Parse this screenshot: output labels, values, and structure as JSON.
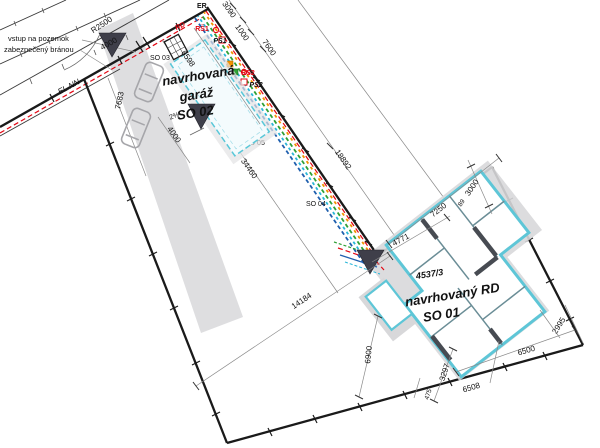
{
  "plan": {
    "notes": {
      "entrance_line1": "vstup na pozemok",
      "entrance_line2": "zabezpečený bránou"
    },
    "road_labels": {
      "el_nn": "EL.NN",
      "r2500": "R2500",
      "width": "4000"
    },
    "utility_labels": {
      "er": "ER",
      "rd": "RD",
      "rs1": "RŠ1",
      "ps1": "PŠ1",
      "rs2": "RŠ2",
      "ps2": "PŠ2",
      "so03": "SO 03",
      "so04": "SO 04",
      "so05": "SO 05"
    },
    "garage": {
      "line1": "navrhovaná",
      "line2": "garáž",
      "line3": "SO 02",
      "slope": "2%"
    },
    "house": {
      "parcel": "4537/3",
      "line1": "navrhovaný RD",
      "line2": "SO 01"
    },
    "dimensions": {
      "d3090": "3090",
      "d1000": "1000",
      "d7600": "7600",
      "d18892": "18892",
      "d34460": "34460",
      "d6598": "6598",
      "d7683": "7683",
      "d4000g": "4000",
      "d14184": "14184",
      "d7250": "7250",
      "d4771": "4771",
      "d3000": "3000",
      "d89": "89",
      "d2995": "2995",
      "d6500": "6500",
      "d6508": "6508",
      "d3297": "3297",
      "d475": "475",
      "d6900": "6900"
    },
    "colors": {
      "boundary": "#1a1a1a",
      "red": "#e30613",
      "wall_cyan": "#5ec6d7",
      "orange": "#f39200",
      "green": "#2fa036",
      "blue": "#1f5fae",
      "light_blue": "#29b6d8",
      "gray": "#d8d8da",
      "dark_marker": "#3f3f4a"
    }
  }
}
